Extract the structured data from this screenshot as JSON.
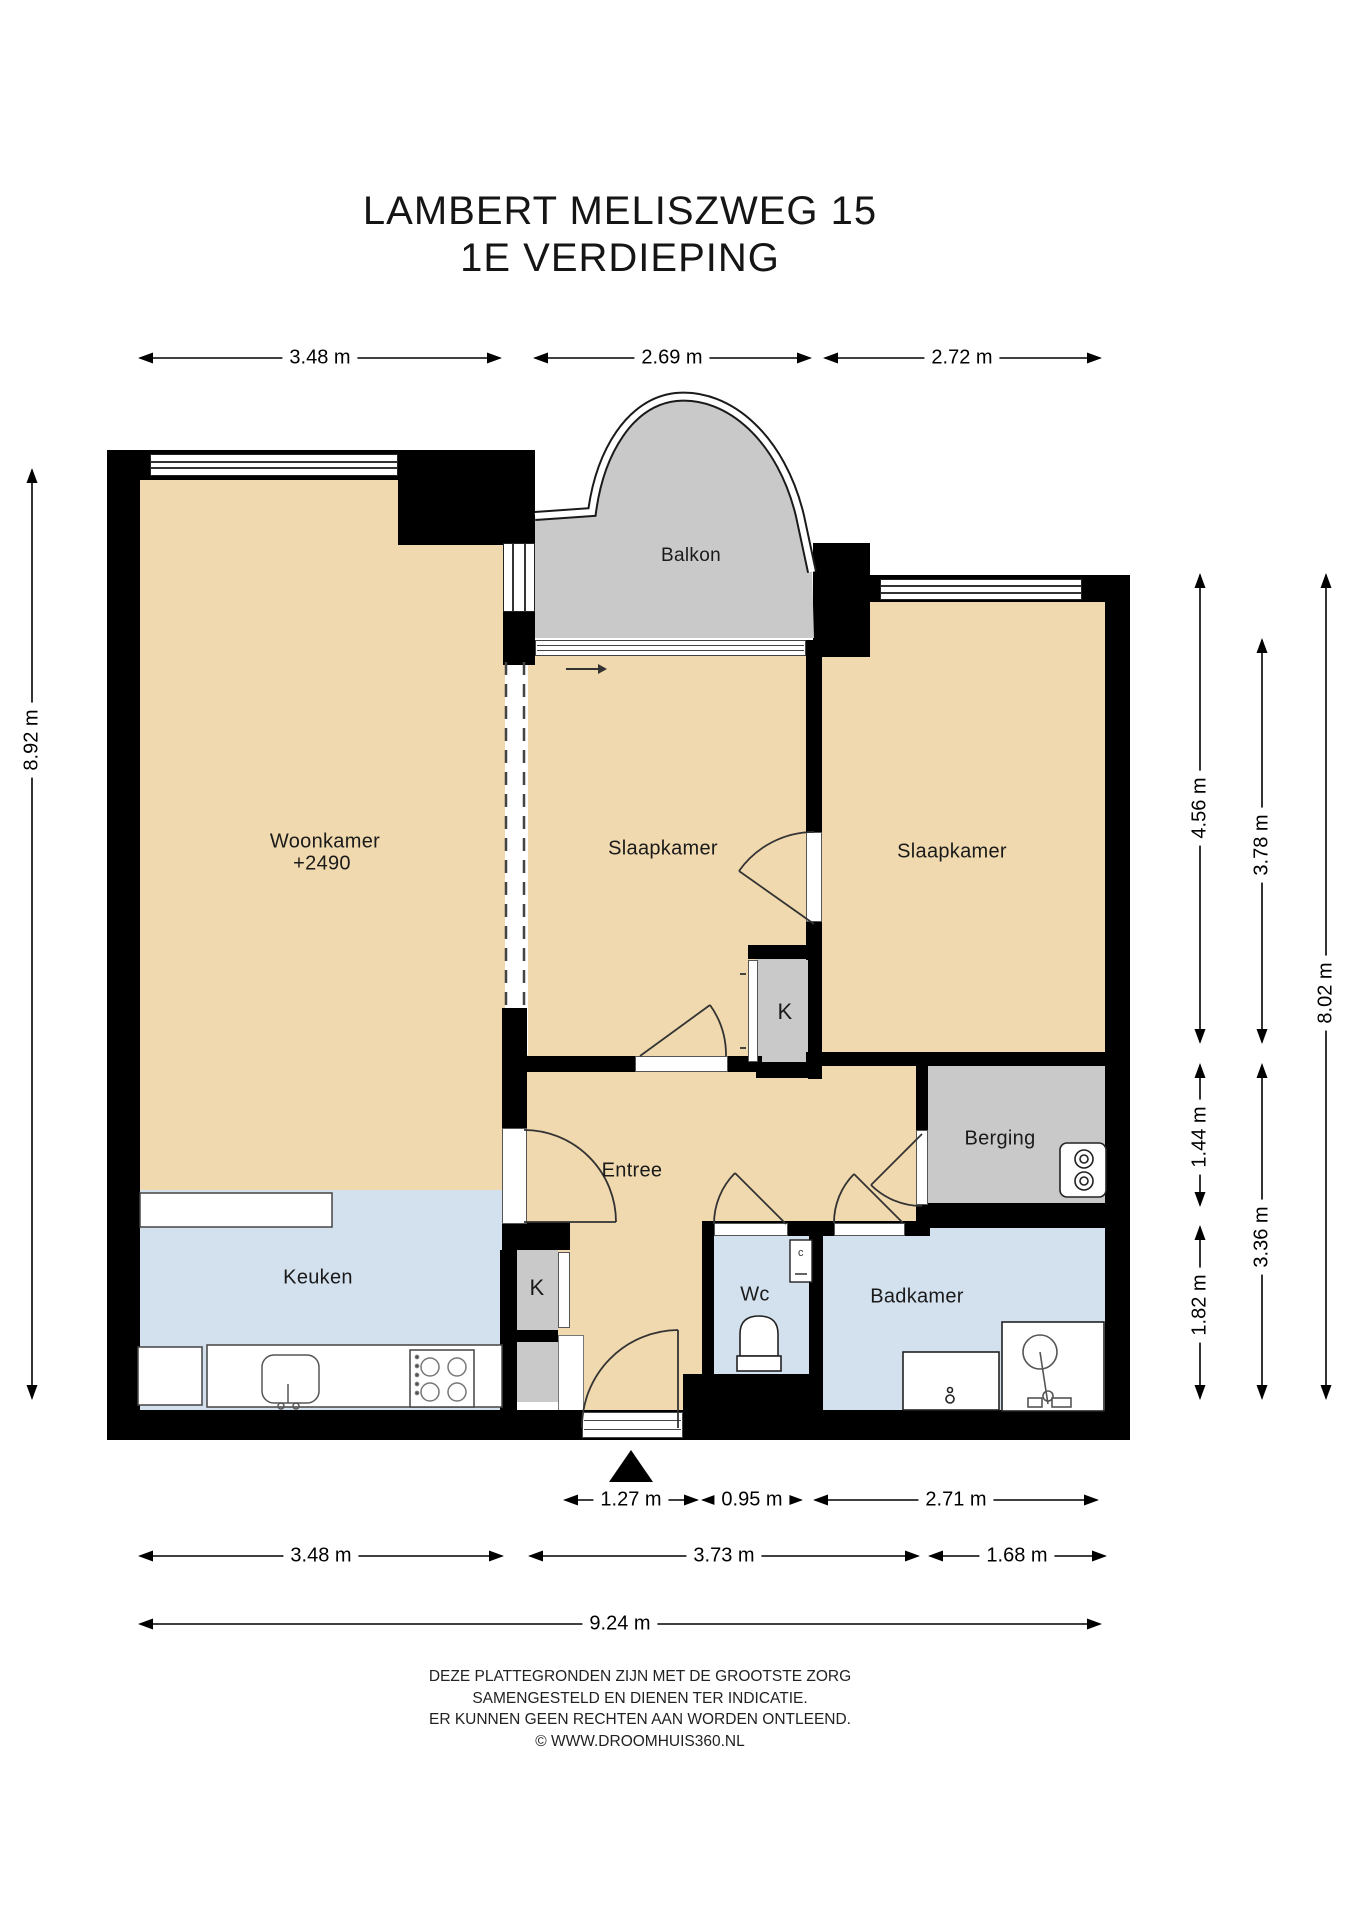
{
  "title": {
    "line1": "LAMBERT MELISZWEG 15",
    "line2": "1E VERDIEPING"
  },
  "rooms": {
    "woonkamer": "Woonkamer",
    "woonkamer_level": "+2490",
    "slaapkamer_left": "Slaapkamer",
    "slaapkamer_right": "Slaapkamer",
    "balkon": "Balkon",
    "entree": "Entree",
    "keuken": "Keuken",
    "wc": "Wc",
    "badkamer": "Badkamer",
    "berging": "Berging",
    "closet_bedrooms": "K",
    "closet_hall": "K"
  },
  "fixtures": {
    "sink_label": "c"
  },
  "dims": {
    "top": [
      "3.48 m",
      "2.69 m",
      "2.72 m"
    ],
    "left": [
      "8.92 m"
    ],
    "right_inner": [
      "4.56 m",
      "1.44 m",
      "1.82 m"
    ],
    "right_middle": [
      "3.78 m",
      "3.36 m"
    ],
    "right_outer": [
      "8.02 m"
    ],
    "bottom_doors": [
      "1.27 m",
      "0.95 m",
      "2.71 m"
    ],
    "bottom_rooms": [
      "3.48 m",
      "3.73 m",
      "1.68 m"
    ],
    "bottom_total": [
      "9.24 m"
    ]
  },
  "footer": [
    "DEZE PLATTEGRONDEN ZIJN MET DE GROOTSTE ZORG",
    "SAMENGESTELD EN DIENEN TER INDICATIE.",
    "ER KUNNEN GEEN RECHTEN AAN WORDEN ONTLEEND.",
    "© WWW.DROOMHUIS360.NL"
  ],
  "colors": {
    "room_tan": "#f0d9ae",
    "service_gray": "#c9c9c9",
    "wet_blue": "#d3e1ef",
    "wall_black": "#000000"
  }
}
